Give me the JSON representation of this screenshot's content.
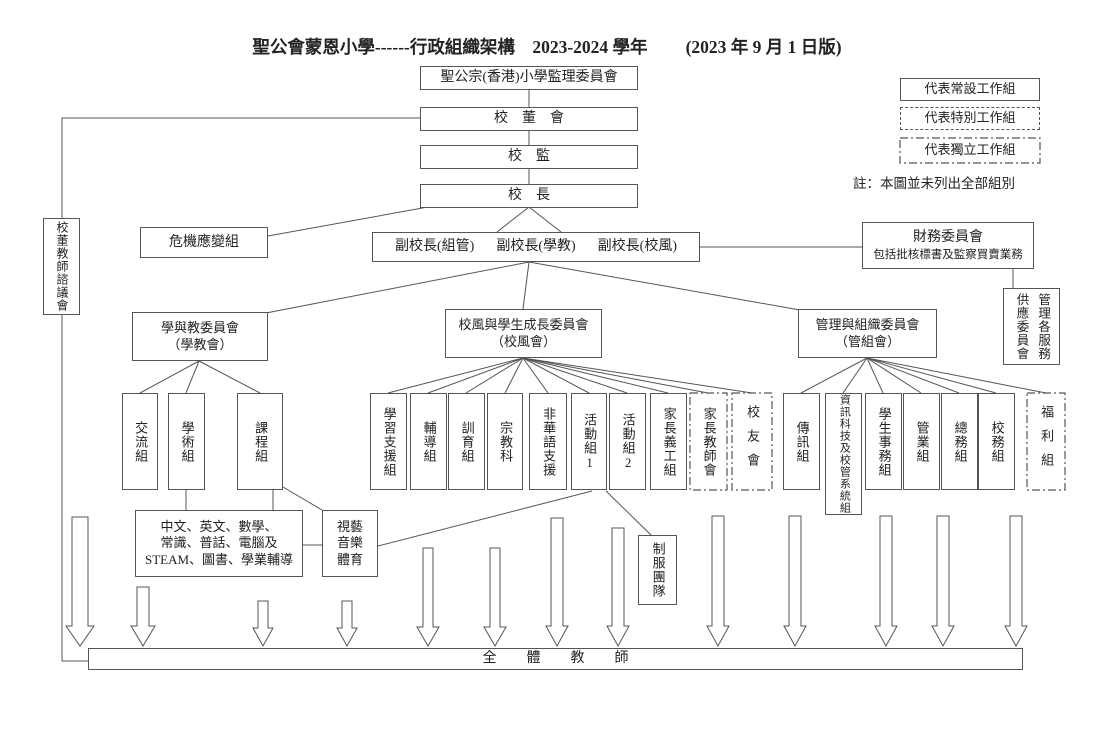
{
  "colors": {
    "line": "#555555",
    "text": "#222222"
  },
  "title": {
    "main": "聖公會蒙恩小學------行政組織架構　2023-2024 學年",
    "version": "(2023 年 9 月 1 日版)"
  },
  "legend": {
    "permanent": "代表常設工作組",
    "special": "代表特別工作組",
    "independent": "代表獨立工作組",
    "note": "註：本圖並未列出全部組別"
  },
  "nodes": {
    "council": "聖公宗(香港)小學監理委員會",
    "school_board": "校董會",
    "supervisor": "校監",
    "principal": "校長",
    "advisory": "校董教師諮議會",
    "crisis": "危機應變組",
    "vice_principals": [
      "副校長(組管)",
      "副校長(學教)",
      "副校長(校風)"
    ],
    "finance": {
      "title": "財務委員會",
      "subtitle": "包括批核標書及監察買賣業務"
    },
    "supply": {
      "left": "供應委員會",
      "right": "管理各服務"
    }
  },
  "committees": {
    "teaching": "學與教委員會\n（學教會）",
    "pastoral": "校風與學生成長委員會\n（校風會）",
    "management": "管理與組織委員會\n（管組會）"
  },
  "groups": {
    "teaching": {
      "children": [
        "交流組",
        "學術組",
        "課程組"
      ]
    },
    "pastoral": {
      "children": [
        "學習支援組",
        "輔導組",
        "訓育組",
        "宗教科",
        "非華語支援",
        "活動組1",
        "活動組2",
        "家長義工組",
        "家長教師會",
        "校友會"
      ]
    },
    "management": {
      "children": [
        "傳訊組",
        "資訊科技及校管系統組",
        "學生事務組",
        "管業組",
        "總務組",
        "校務組",
        "福利組"
      ]
    }
  },
  "lower": {
    "subjects": "中文、英文、數學、\n常識、普話、電腦及\nSTEAM、圖書、學業輔導",
    "arts": "視藝\n音樂\n體育",
    "uniform": "制服團隊",
    "all_teachers": "全體教師"
  }
}
